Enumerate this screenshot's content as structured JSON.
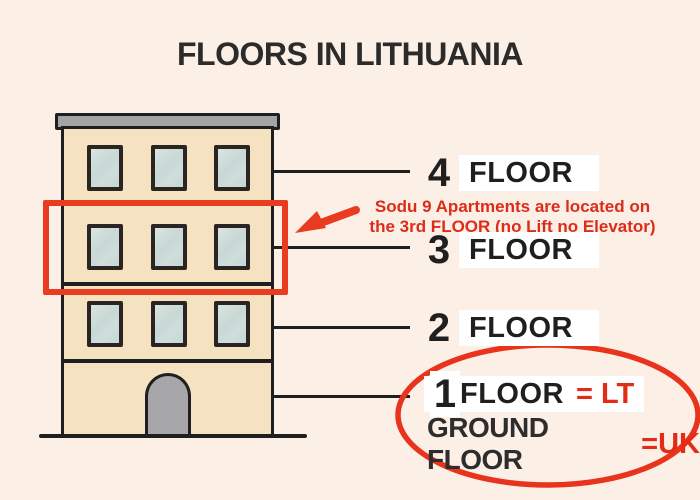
{
  "title": "FLOORS IN LITHUANIA",
  "annotation": {
    "line1": "Sodu 9 Apartments are located on",
    "line2": "the 3rd FLOOR (no Lift no Elevator)"
  },
  "floors": [
    {
      "number": "4",
      "label": "FLOOR"
    },
    {
      "number": "3",
      "label": "FLOOR"
    },
    {
      "number": "2",
      "label": "FLOOR"
    },
    {
      "number": "1",
      "label": "FLOOR",
      "suffix": "= LT"
    }
  ],
  "ground": {
    "label": "GROUND FLOOR",
    "suffix": "=UK"
  },
  "colors": {
    "background": "#fcefe6",
    "wall": "#f5e2c1",
    "roof_gray": "#a4a4a6",
    "door_gray": "#a7a7a9",
    "window_glass": "#c8d8d4",
    "outline_dark": "#1f1f1f",
    "accent_red": "#e83b1f",
    "text_red": "#dd2c1a",
    "label_box": "#ffffff"
  }
}
